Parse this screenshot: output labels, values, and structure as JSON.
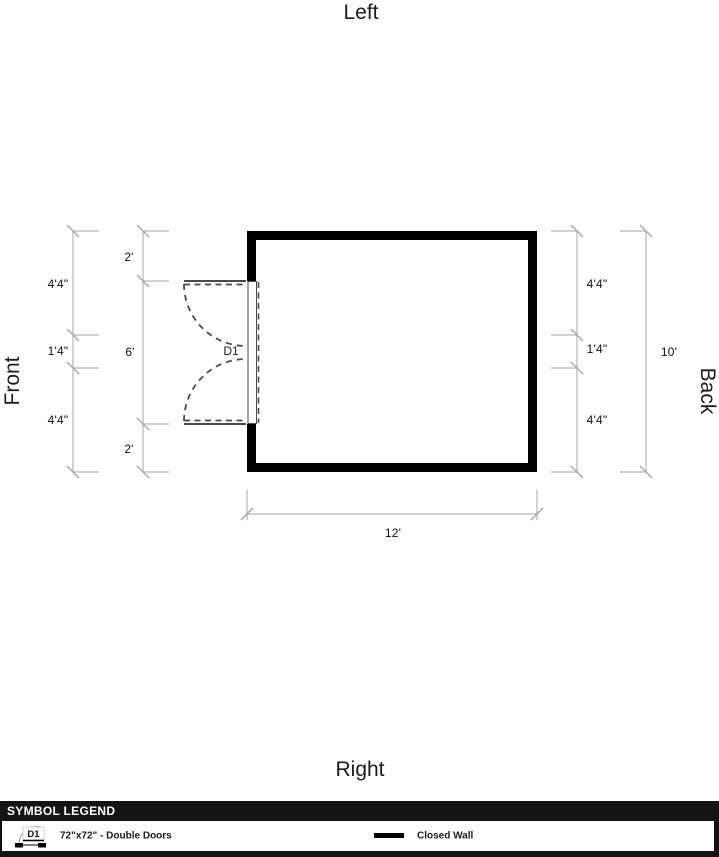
{
  "orientation_labels": {
    "top": "Left",
    "bottom": "Right",
    "left": "Front",
    "right": "Back"
  },
  "dimensions": {
    "left_outer": [
      "4'4\"",
      "1'4\"",
      "4'4\""
    ],
    "left_inner": [
      "2'",
      "6'",
      "2'"
    ],
    "right_inner": [
      "4'4\"",
      "1'4\"",
      "4'4\""
    ],
    "right_outer": "10'",
    "bottom": "12'"
  },
  "room": {
    "width_label": "12'",
    "height_label": "10'",
    "wall_style": "Closed Wall"
  },
  "door": {
    "label": "D1",
    "type": "Double Doors",
    "size": "72\"x72\""
  },
  "legend": {
    "title": "SYMBOL LEGEND",
    "items": [
      {
        "symbol": "D1",
        "label": "72\"x72\" - Double Doors"
      },
      {
        "symbol": "closed-wall-line",
        "label": "Closed Wall"
      }
    ]
  },
  "colors": {
    "wall": "#000000",
    "dimension_line": "#b3b3b3",
    "door_swing": "#4a4a4a",
    "legend_bar": "#141414"
  }
}
